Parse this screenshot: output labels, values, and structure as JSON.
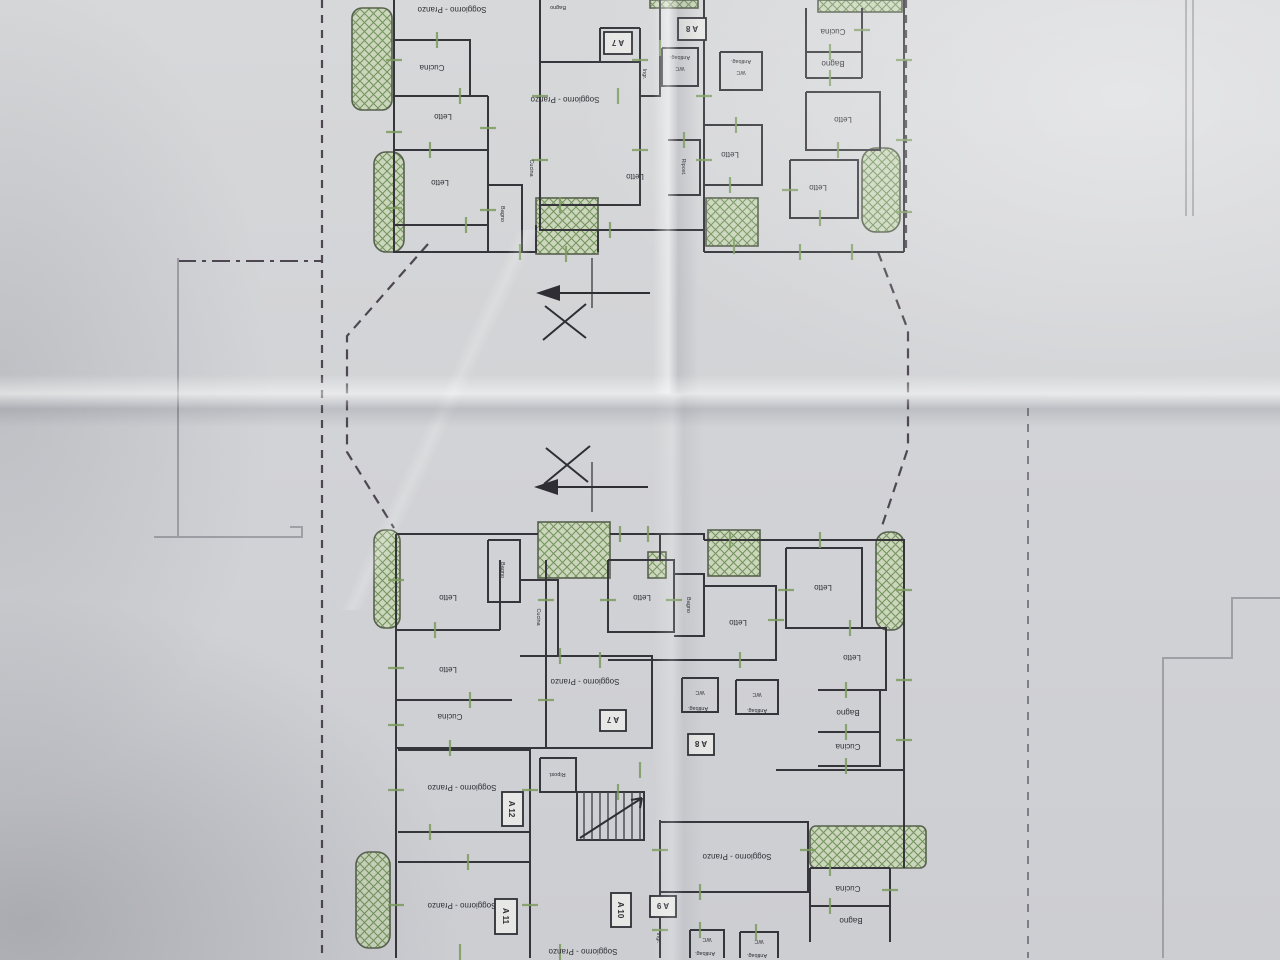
{
  "labels": {
    "soggiorno_pranzo": "Soggiorno - Pranzo",
    "letto": "Letto",
    "cucina": "Cucina",
    "bagno": "Bagno",
    "wc": "WC",
    "antibagno": "Antibag.",
    "ripostiglio": "Ripost.",
    "ingresso": "Ingr."
  },
  "badges": {
    "a7": "A 7",
    "a8": "A 8",
    "a9": "A 9",
    "a10": "A 10",
    "a11": "A 11",
    "a12": "A 12"
  },
  "colors": {
    "paper": "#d2d3d6",
    "ink": "#35353b",
    "balcony_fill": "#cbd6bd",
    "balcony_hatch": "#74945e",
    "dimension_green": "#7d9b5e",
    "boundary_dash": "#4e4752"
  }
}
